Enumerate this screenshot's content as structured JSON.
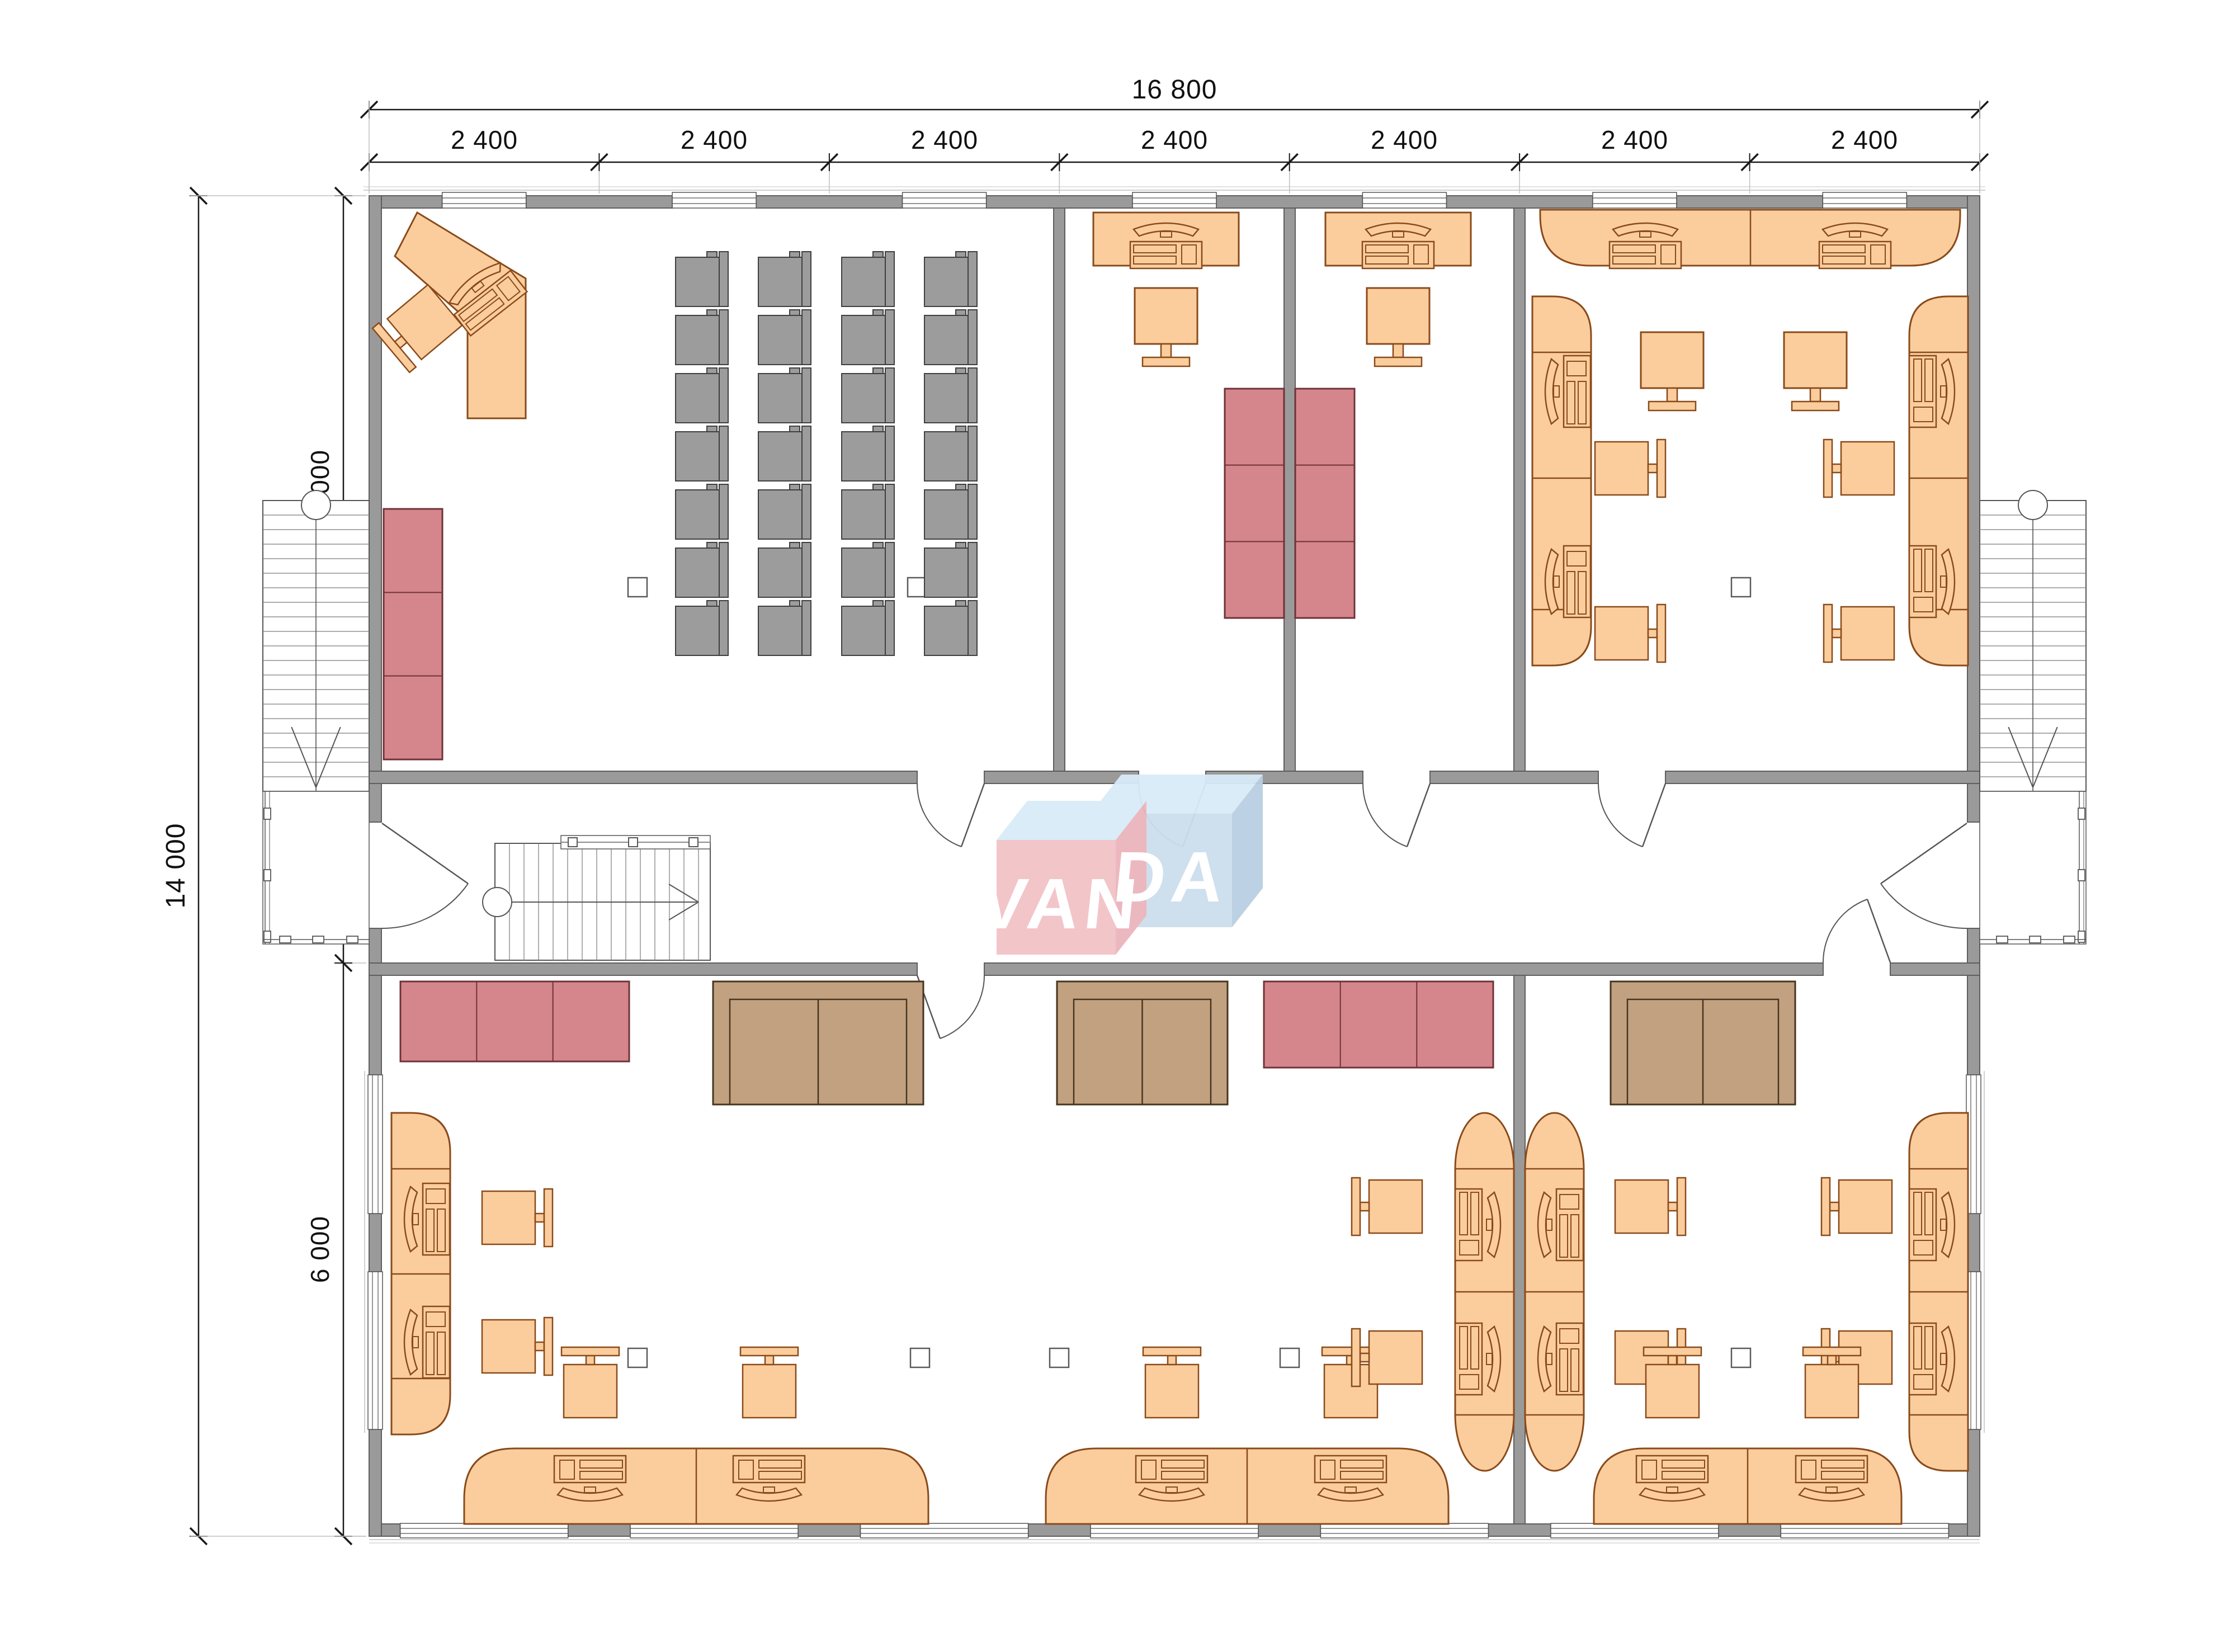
{
  "dimensions": {
    "top_total": "16 800",
    "top_segments": [
      "2 400",
      "2 400",
      "2 400",
      "2 400",
      "2 400",
      "2 400",
      "2 400"
    ],
    "left_total": "14 000",
    "left_segments": [
      "6 000",
      "2 000",
      "6 000"
    ]
  },
  "logo": {
    "text": "VANDA",
    "left_letters": "VAN",
    "right_letters": "DA",
    "pink_front": "#f2c2c7",
    "pink_side": "#ecb5bc",
    "blue_front": "#ccdeee",
    "blue_side": "#b9cfe2",
    "top_face": "#d8ebf8",
    "letter_color": "#ffffff"
  },
  "palette": {
    "background": "#ffffff",
    "wall_fill": "#9a9a9a",
    "wall_edge": "#5e5e5e",
    "furniture_fill": "#fbcd9c",
    "furniture_stroke": "#8a4a1a",
    "chair_gray_fill": "#9c9c9c",
    "chair_gray_stroke": "#3f3f3f",
    "sofa_red_fill": "#d5868c",
    "sofa_red_stroke": "#6e3338",
    "sofa_brown_fill": "#c2a180",
    "sofa_brown_stroke": "#46351f",
    "dim_line": "#1a1a1a",
    "dim_text": "#111111",
    "thin_line": "#555555",
    "outline_light": "#c0c0c0"
  }
}
